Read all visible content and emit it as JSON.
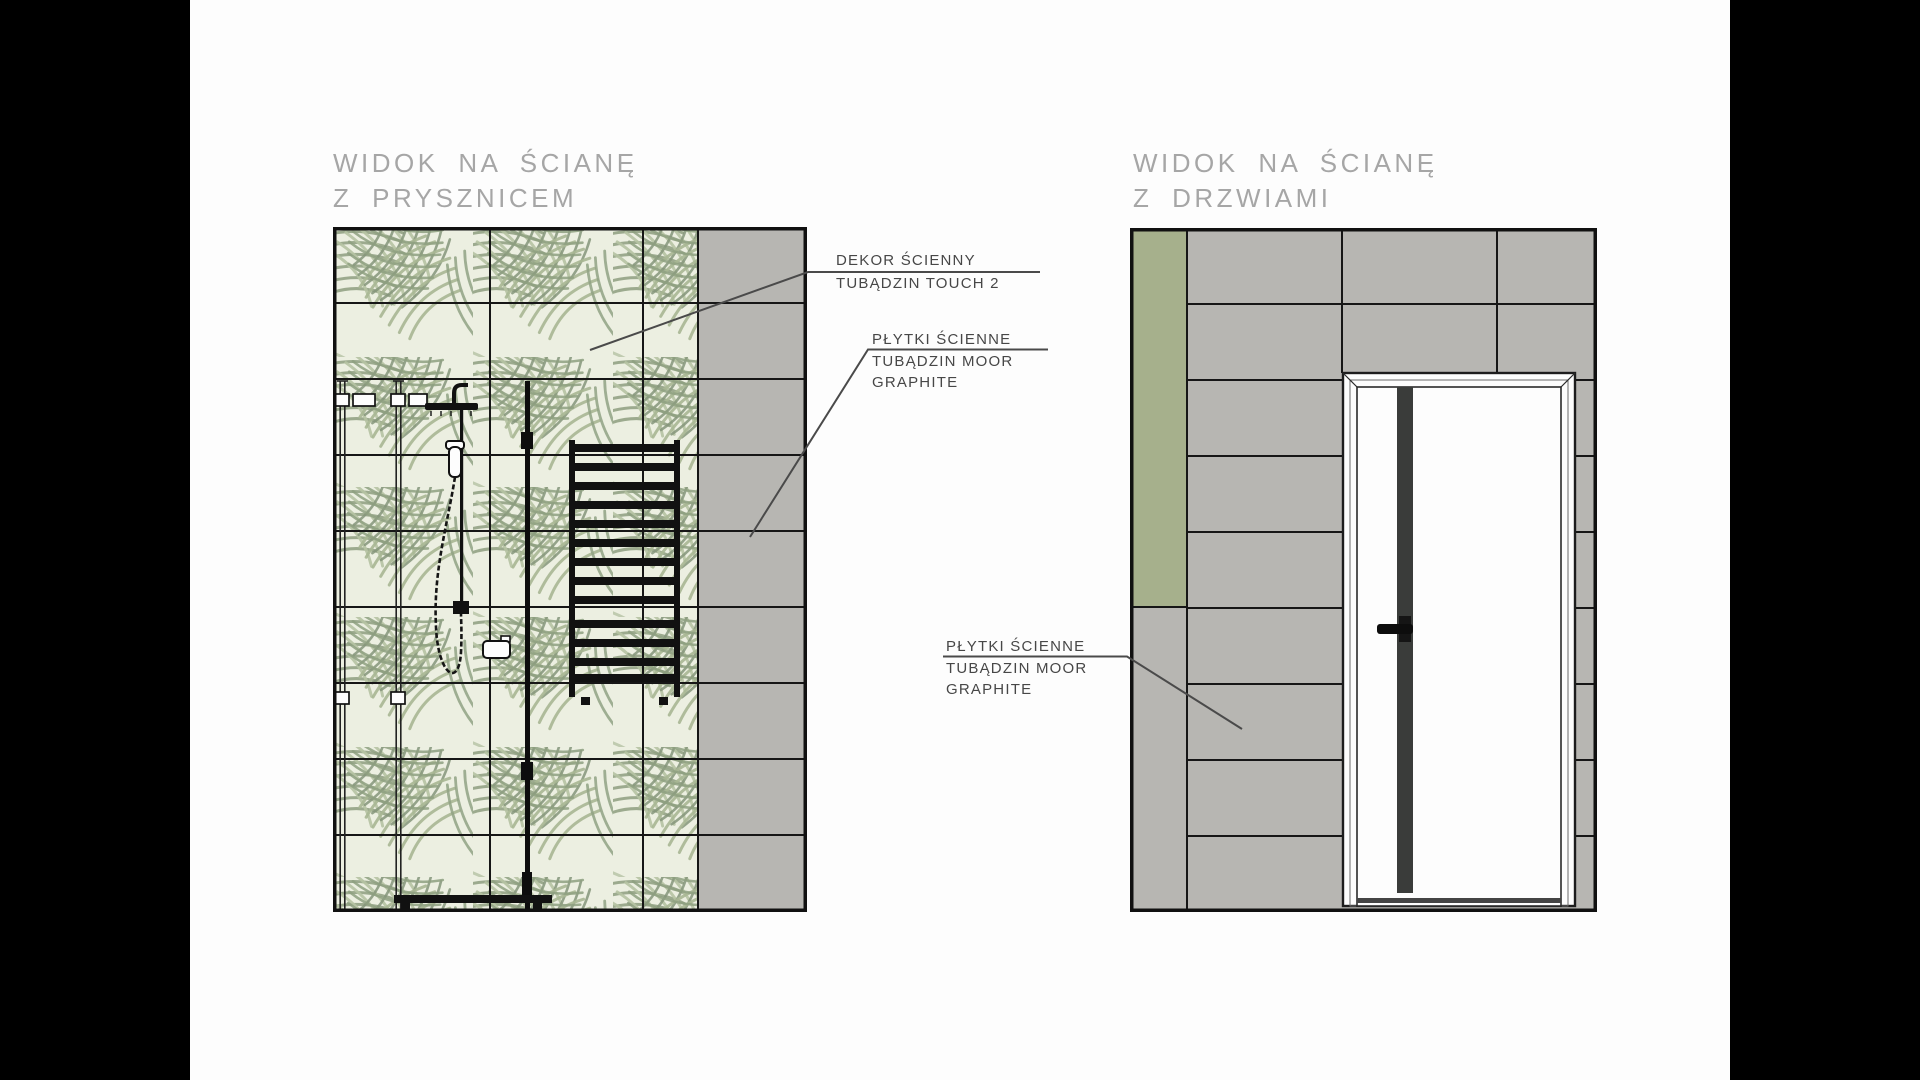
{
  "board": {
    "background": "#fdfdfd",
    "letterbox_color": "#000000"
  },
  "panels": [
    {
      "id": "shower-wall",
      "title_line1": "WIDOK NA ŚCIANĘ",
      "title_line2": "Z PRYSZNICEM",
      "fixtures": [
        "shower-glass-enclosure",
        "rain-shower-set",
        "towel-radiator",
        "soap-shelf",
        "shower-tray"
      ]
    },
    {
      "id": "door-wall",
      "title_line1": "WIDOK NA ŚCIANĘ",
      "title_line2": "Z DRZWIAMI",
      "fixtures": [
        "interior-door"
      ]
    }
  ],
  "labels": [
    {
      "id": "wall-decor",
      "line1": "DEKOR ŚCIENNY",
      "line2": "TUBĄDZIN TOUCH 2"
    },
    {
      "id": "wall-tiles-shower",
      "line1": "PŁYTKI ŚCIENNE",
      "line2": "TUBĄDZIN MOOR",
      "line3": "GRAPHITE"
    },
    {
      "id": "wall-tiles-door",
      "line1": "PŁYTKI ŚCIENNE",
      "line2": "TUBĄDZIN MOOR",
      "line3": "GRAPHITE"
    }
  ],
  "colors": {
    "tile_graphite": "#b7b6b2",
    "tile_green_accent": "#a6b08c",
    "leaf_tile_background": "#ecefe1",
    "leaf_stroke_mid": "#93a385",
    "leaf_stroke_light": "#b6c3a3",
    "leaf_stroke_dark": "#85957a",
    "drawing_line": "#161616",
    "title_gray": "#a6a6a6",
    "label_gray": "#474747",
    "door_stripe": "#3a3c3a"
  }
}
